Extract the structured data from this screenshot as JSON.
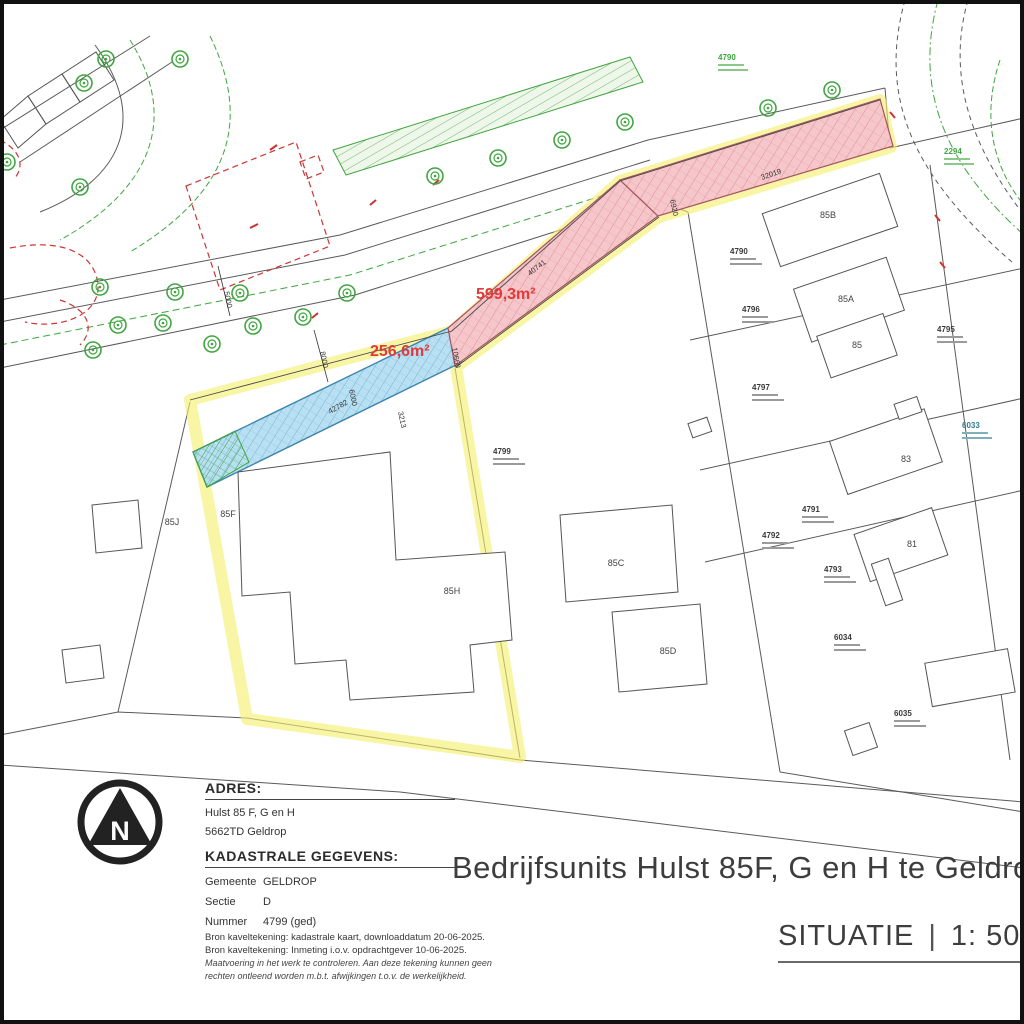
{
  "page": {
    "title": "Bedrijfsunits Hulst 85F, G en H te Geldrop",
    "situatie_label": "SITUATIE",
    "separator": "|",
    "scale": "1: 500"
  },
  "adres": {
    "heading": "ADRES:",
    "line1": "Hulst 85 F, G en H",
    "line2": "5662TD  Geldrop"
  },
  "kadastraal": {
    "heading": "KADASTRALE GEGEVENS:",
    "rows": [
      {
        "label": "Gemeente",
        "value": "GELDROP"
      },
      {
        "label": "Sectie",
        "value": "D"
      },
      {
        "label": "Nummer",
        "value": "4799 (ged)"
      }
    ]
  },
  "bron": {
    "line1": "Bron kaveltekening: kadastrale kaart, downloaddatum 20-06-2025.",
    "line2": "Bron kaveltekening: Inmeting i.o.v. opdrachtgever 10-06-2025.",
    "disclaimer1": "Maatvoering in het werk te controleren. Aan deze tekening kunnen geen",
    "disclaimer2": "rechten ontleend worden m.b.t. afwijkingen t.o.v. de werkelijkheid."
  },
  "map": {
    "north_label": "N",
    "area_blue": "256,6m²",
    "area_pink": "599,3m²",
    "colors": {
      "highlight_yellow": "#f3ef6d",
      "plot_blue_fill": "#b9e0f2",
      "plot_blue_line": "#3f85ad",
      "plot_pink_fill": "#f5c6ca",
      "plot_pink_line": "#c46a74",
      "survey_red": "#cc3434",
      "vegetation_green": "#3fa63f",
      "area_label_red": "#e03a3a"
    },
    "dimensions": [
      {
        "t": "5000"
      },
      {
        "t": "8000"
      },
      {
        "t": "6000"
      },
      {
        "t": "42782"
      },
      {
        "t": "3213"
      },
      {
        "t": "10668"
      },
      {
        "t": "40741"
      },
      {
        "t": "6920"
      },
      {
        "t": "32019"
      }
    ],
    "parcels": [
      {
        "num": "4790"
      },
      {
        "num": "2294"
      },
      {
        "num": "4790"
      },
      {
        "num": "4796"
      },
      {
        "num": "4797"
      },
      {
        "num": "4799"
      },
      {
        "num": "4795"
      },
      {
        "num": "6033"
      },
      {
        "num": "4791"
      },
      {
        "num": "4792"
      },
      {
        "num": "4793"
      },
      {
        "num": "6034"
      },
      {
        "num": "6035"
      }
    ],
    "buildings": [
      "85J",
      "85F",
      "85H",
      "85C",
      "85D",
      "85B",
      "85A",
      "85",
      "83",
      "81"
    ]
  }
}
